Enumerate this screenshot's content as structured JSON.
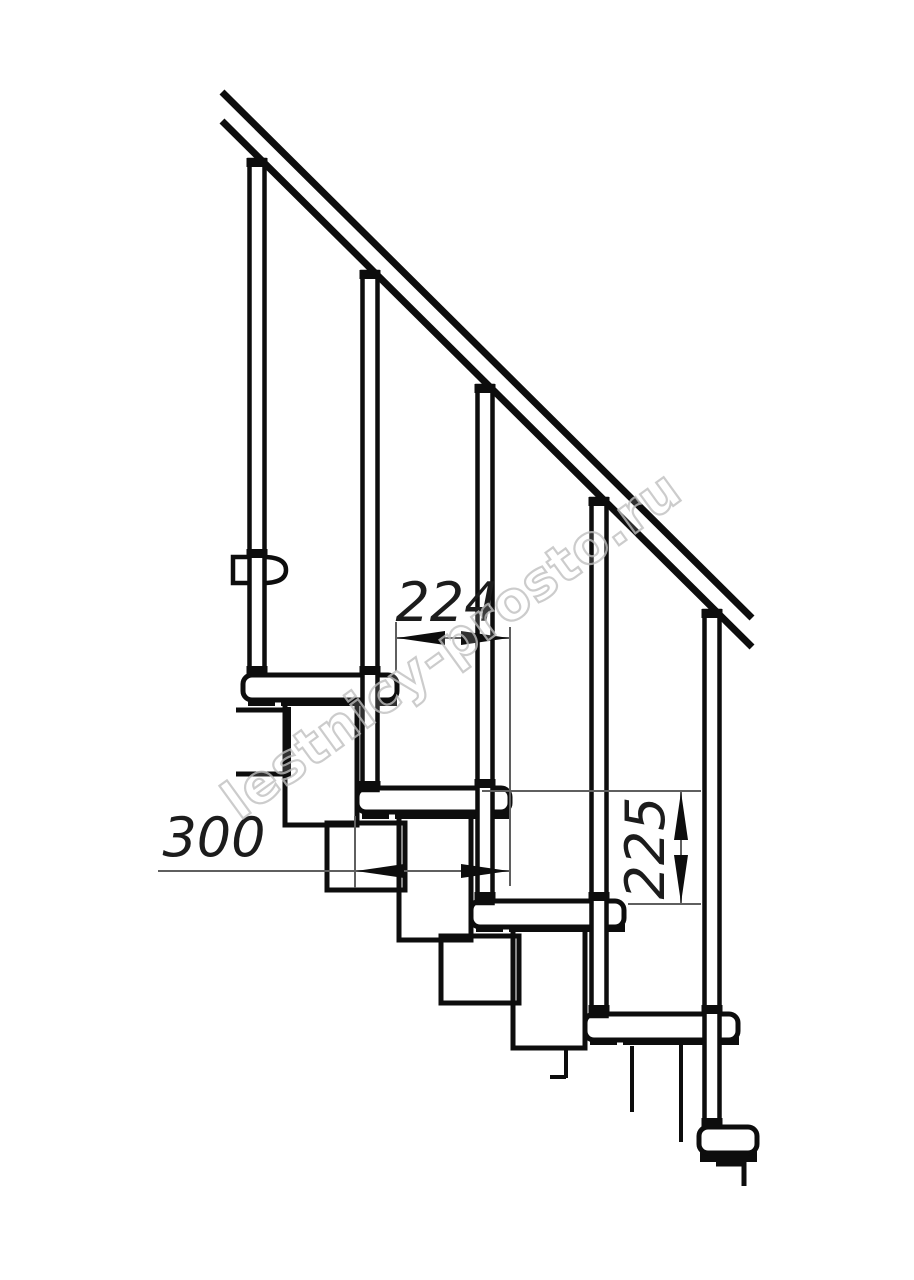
{
  "watermark": {
    "text": "lestnicy-prosto.ru",
    "color": "#c0c0c0"
  },
  "dimensions": {
    "step_run": {
      "value": "224",
      "orientation": "horizontal"
    },
    "tread_depth": {
      "value": "300",
      "orientation": "horizontal"
    },
    "step_rise": {
      "value": "225",
      "orientation": "vertical"
    }
  },
  "colors": {
    "ink": "#0d0d0d",
    "dimension_lines": "#5f5f5f",
    "dimension_text": "#1c1c1c",
    "background": "#ffffff"
  }
}
